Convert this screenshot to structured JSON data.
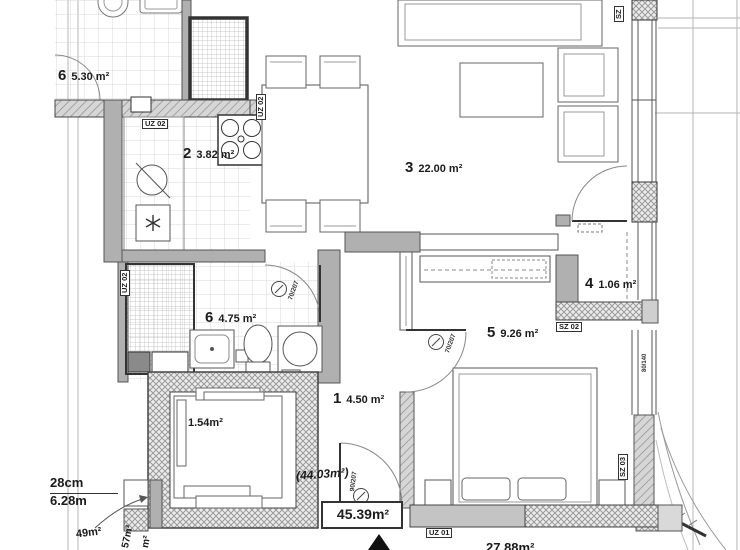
{
  "title": "apartment-floor-plan",
  "rooms": {
    "hall": {
      "number": "1",
      "area": "4.50 m²"
    },
    "kitchen": {
      "number": "2",
      "area": "3.82 m²"
    },
    "living": {
      "number": "3",
      "area": "22.00 m²"
    },
    "balcony": {
      "number": "4",
      "area": "1.06 m²"
    },
    "bedroom": {
      "number": "5",
      "area": "9.26 m²"
    },
    "bath": {
      "number": "6",
      "area": "4.75 m²"
    },
    "neighbor": {
      "number": "6",
      "area": "5.30 m²"
    },
    "elevator": {
      "area": "1.54m²"
    }
  },
  "totals": {
    "usable_boxed": "45.39m²",
    "paren": "(44.03m²)",
    "bottom": "27.88m²"
  },
  "dims": {
    "top": "28cm",
    "bottom": "6.28m",
    "rot_a": "49m²",
    "rot_b": "57m²",
    "rot_c": "m²"
  },
  "wall_labels": {
    "uz01": "UZ 01",
    "uz02": "UZ 02",
    "sz": "SZ",
    "sz02": "SZ 02",
    "sz03": "SZ 03"
  },
  "openings": {
    "entry_door": "90/207",
    "bedroom_door": "70/207",
    "bath_door": "70/207",
    "bedroom_window": "80/140"
  },
  "colors": {
    "wall_gray": "#b0b0b0",
    "line_dark": "#444444",
    "tile_line": "#d8d8d8"
  }
}
